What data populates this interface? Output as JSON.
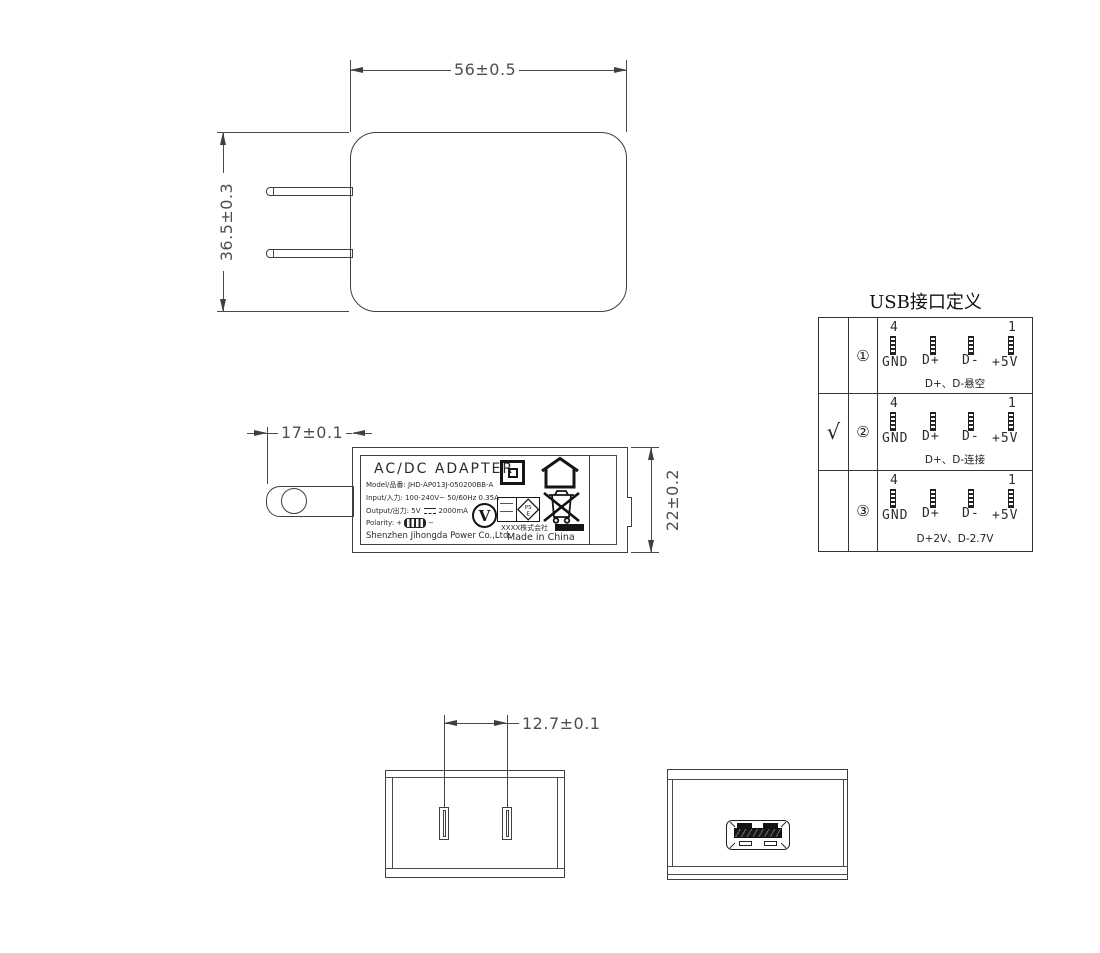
{
  "dimensions": {
    "front_width": "56±0.5",
    "front_height": "36.5±0.3",
    "side_prong": "17±0.1",
    "side_depth": "22±0.2",
    "pin_spacing": "12.7±0.1"
  },
  "label": {
    "title": "AC/DC  ADAPTER",
    "model": "Model/品番: JHD-AP013J-050200BB-A",
    "input": "Input/入力: 100-240V~ 50/60Hz 0.35A",
    "output_prefix": "Output/出力: 5V",
    "output_suffix": "2000mA",
    "polarity_label": "Polarity:",
    "polarity_plus": "+",
    "polarity_minus": "−",
    "company": "Shenzhen Jihongda Power Co.,Ltd.",
    "cert_company": "XXXX株式会社",
    "made_in": "Made in China",
    "efficiency_mark": "V",
    "pse_top": "PS",
    "pse_bottom": "E"
  },
  "usb_table": {
    "title": "USB接口定义",
    "pin4": "4",
    "pin1": "1",
    "pin_labels": [
      "GND",
      "D+",
      "D-",
      "+5V"
    ],
    "rows": [
      {
        "check": "",
        "num": "①",
        "note": "D+、D-悬空"
      },
      {
        "check": "√",
        "num": "②",
        "note": "D+、D-连接"
      },
      {
        "check": "",
        "num": "③",
        "note": "D+2V、D-2.7V"
      }
    ]
  }
}
